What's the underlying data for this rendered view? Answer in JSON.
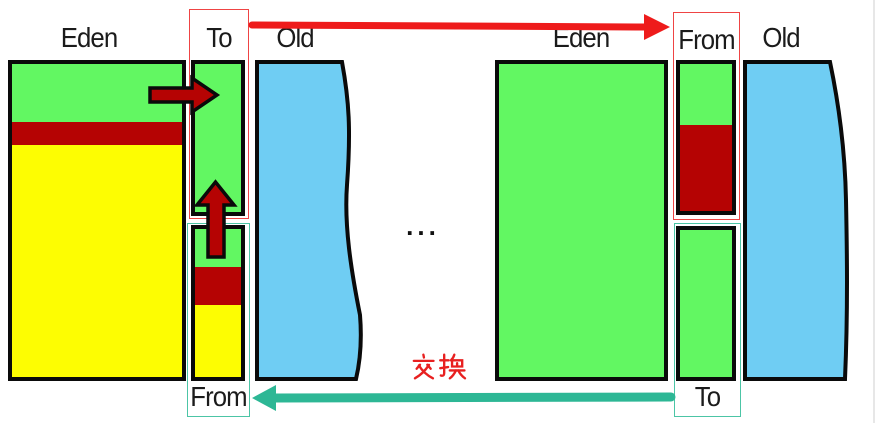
{
  "diagram": {
    "left": {
      "eden_label": "Eden",
      "to_label": "To",
      "old_label": "Old",
      "from_label": "From"
    },
    "right": {
      "eden_label": "Eden",
      "from_label": "From",
      "old_label": "Old",
      "to_label": "To"
    },
    "center": {
      "ellipsis": "...",
      "swap_label": "交换"
    },
    "colors": {
      "free_green": "#62f762",
      "live_yellow": "#fdfd02",
      "garbage_dark_red": "#b50303",
      "old_gen_blue": "#6fcdf3",
      "swap_arrow_red": "#ee1b1b",
      "swap_arrow_teal": "#2db795",
      "to_frame_red": "#ef4444",
      "from_frame_teal": "#4cc5a6",
      "swap_text_red": "#e82020"
    }
  }
}
